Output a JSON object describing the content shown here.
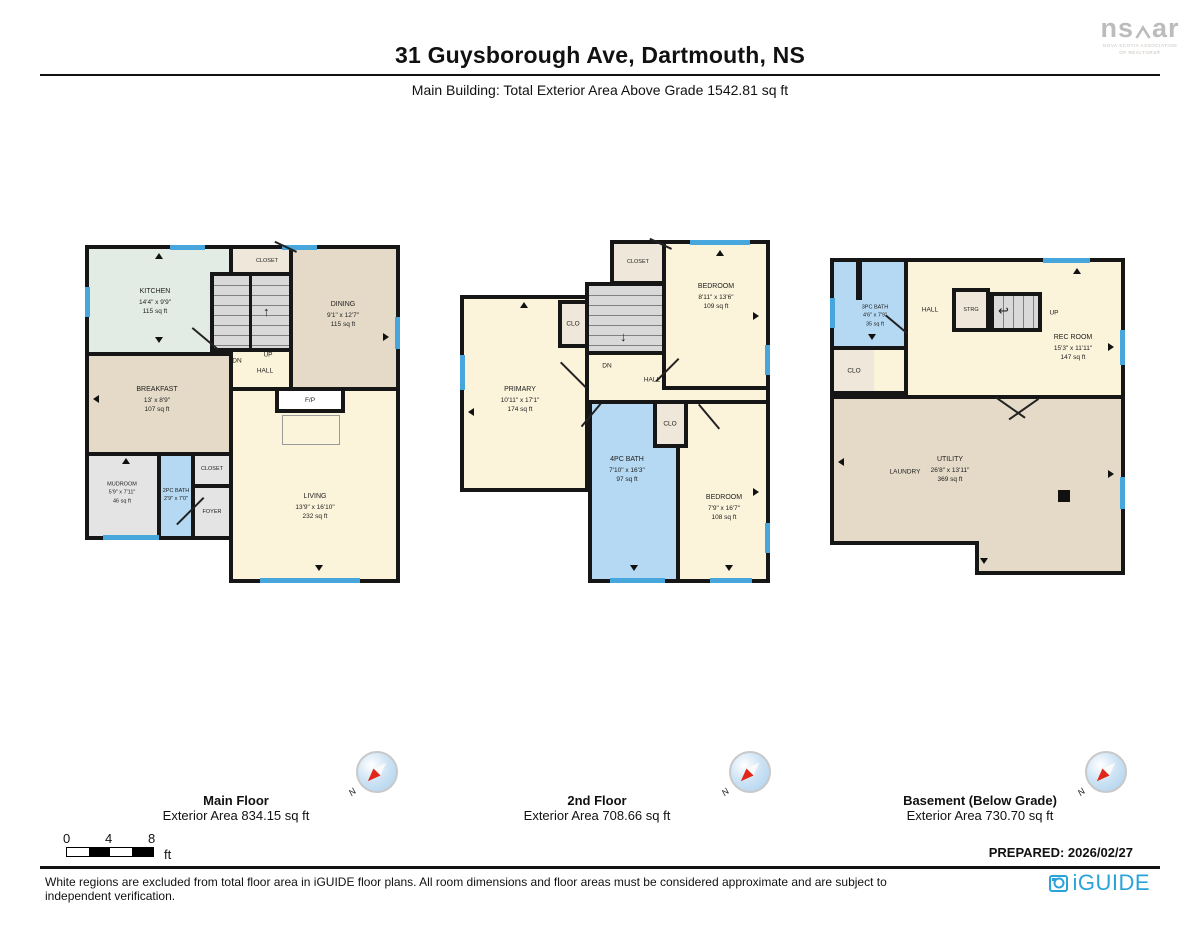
{
  "header": {
    "title": "31 Guysborough Ave, Dartmouth, NS",
    "subtitle": "Main Building: Total Exterior Area Above Grade 1542.81 sq ft"
  },
  "brand": {
    "name_left": "ns",
    "name_right": "ar",
    "tagline1": "NOVA SCOTIA ASSOCIATION",
    "tagline2": "OF REALTORS®"
  },
  "plans": {
    "main": {
      "caption": "Main Floor",
      "caption_area": "Exterior Area 834.15 sq ft",
      "rooms": {
        "kitchen": {
          "name": "KITCHEN",
          "dims": "14'4\" x 9'9\"",
          "area": "115 sq ft"
        },
        "closet_top": {
          "name": "CLOSET"
        },
        "dining": {
          "name": "DINING",
          "dims": "9'1\" x 12'7\"",
          "area": "115 sq ft"
        },
        "breakfast": {
          "name": "BREAKFAST",
          "dims": "13' x 8'9\"",
          "area": "107 sq ft"
        },
        "hall": "HALL",
        "up": "UP",
        "dn": "DN",
        "living": {
          "name": "LIVING",
          "dims": "13'9\" x 16'10\"",
          "area": "232 sq ft"
        },
        "mudroom": {
          "name": "MUDROOM",
          "dims": "5'9\" x 7'11\"",
          "area": "46 sq ft"
        },
        "bath2pc": {
          "name": "2PC BATH",
          "dims": "2'9\" x 7'0\""
        },
        "closet_foyer": {
          "name": "CLOSET"
        },
        "foyer": {
          "name": "FOYER"
        },
        "fp": "F/P"
      }
    },
    "second": {
      "caption": "2nd Floor",
      "caption_area": "Exterior Area 708.66 sq ft",
      "rooms": {
        "closet": {
          "name": "CLOSET"
        },
        "bedroom1": {
          "name": "BEDROOM",
          "dims": "8'11\" x 13'6\"",
          "area": "109 sq ft"
        },
        "clo1": "CLO",
        "dn": "DN",
        "hall": "HALL",
        "primary": {
          "name": "PRIMARY",
          "dims": "10'11\" x 17'1\"",
          "area": "174 sq ft"
        },
        "bath4pc": {
          "name": "4PC BATH",
          "dims": "7'10\" x 16'3\"",
          "area": "97 sq ft"
        },
        "clo2": "CLO",
        "bedroom2": {
          "name": "BEDROOM",
          "dims": "7'9\" x 16'7\"",
          "area": "108 sq ft"
        }
      }
    },
    "basement": {
      "caption": "Basement (Below Grade)",
      "caption_area": "Exterior Area 730.70 sq ft",
      "rooms": {
        "bath3pc": {
          "name": "3PC BATH",
          "dims": "4'6\" x 7'9\"",
          "area": "35 sq ft"
        },
        "hall": "HALL",
        "strg": "STRG",
        "up": "UP",
        "rec": {
          "name": "REC ROOM",
          "dims": "15'3\" x 11'11\"",
          "area": "147 sq ft"
        },
        "clo": "CLO",
        "laundry": "LAUNDRY",
        "utility": {
          "name": "UTILITY",
          "dims": "26'8\" x 13'11\"",
          "area": "369 sq ft"
        }
      }
    }
  },
  "compass_n": "N",
  "scale_bar": {
    "t0": "0",
    "t4": "4",
    "t8": "8",
    "unit": "ft"
  },
  "footer": {
    "prepared": "PREPARED: 2026/02/27",
    "disclaimer": "White regions are excluded from total floor area in iGUIDE floor plans. All room dimensions and floor areas must be considered approximate and are subject to independent verification.",
    "logo_text": "iGUIDE"
  }
}
